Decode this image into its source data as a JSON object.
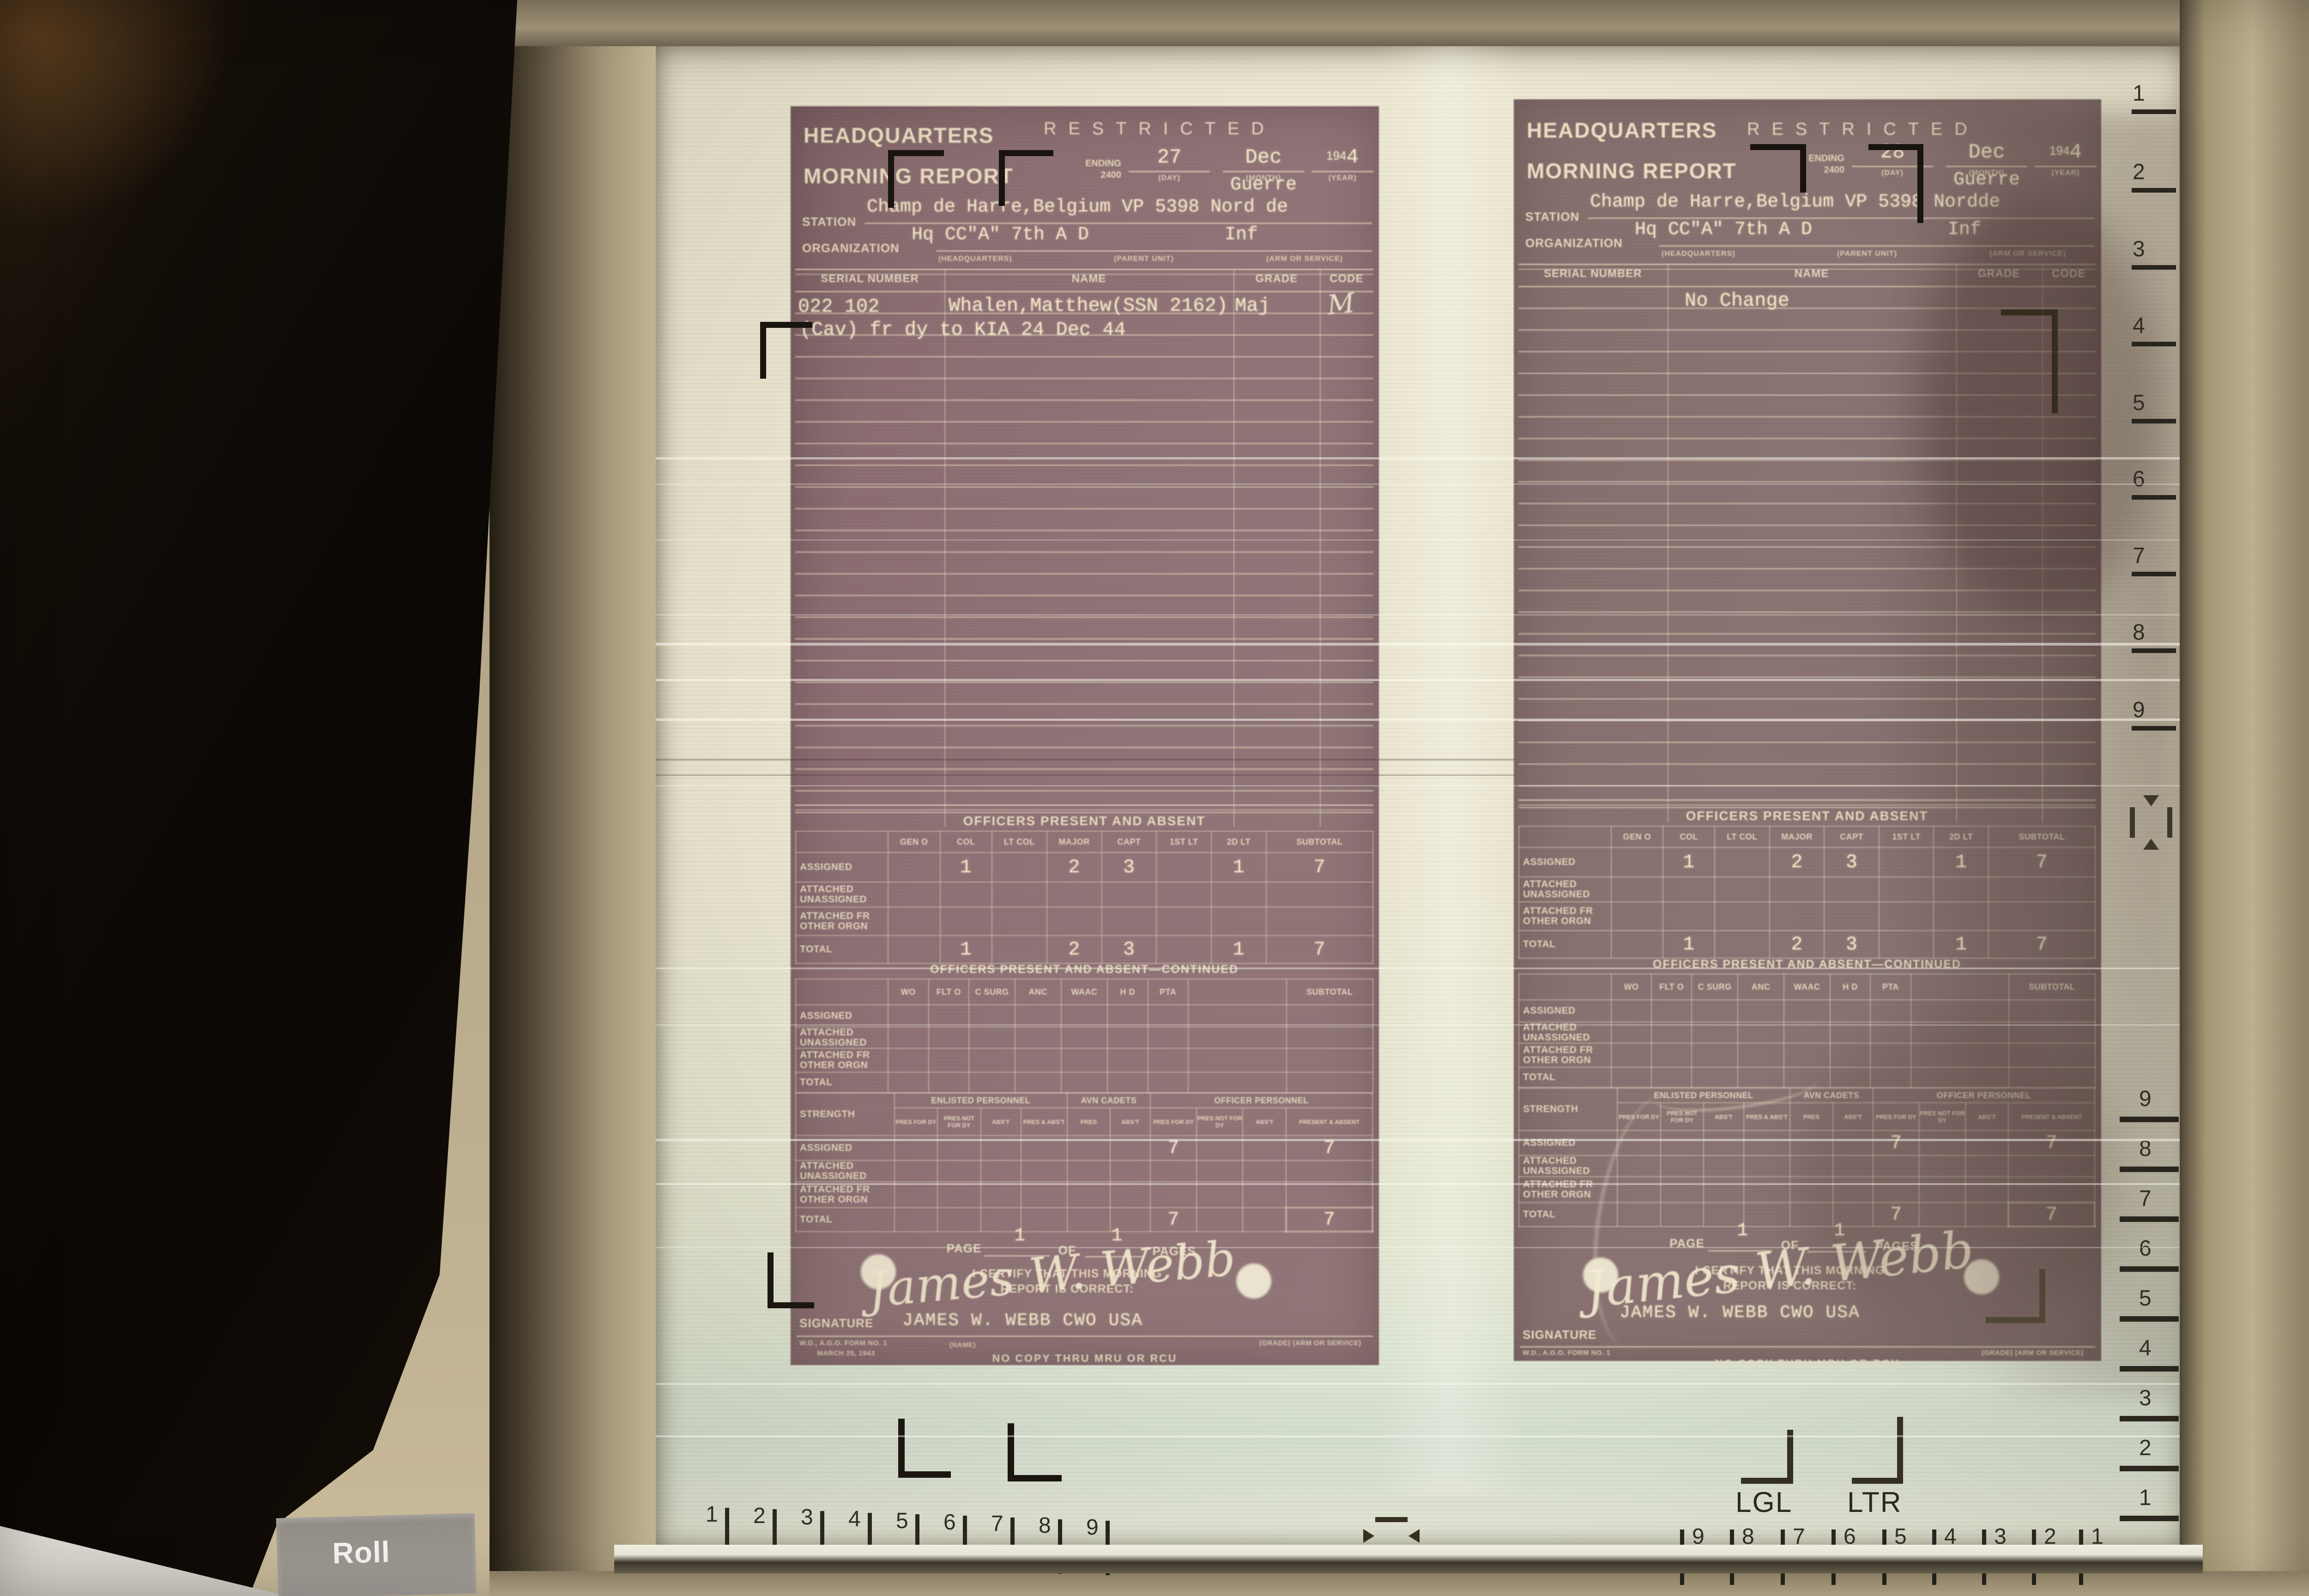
{
  "machine": {
    "roll_button": "Roll",
    "lgl_label": "LGL",
    "ltr_label": "LTR",
    "rulers": {
      "bottom_left": [
        "1",
        "2",
        "3",
        "4",
        "5",
        "6",
        "7",
        "8",
        "9"
      ],
      "bottom_right": [
        "9",
        "8",
        "7",
        "6",
        "5",
        "4",
        "3",
        "2",
        "1"
      ],
      "right_top": [
        "1",
        "2",
        "3",
        "4",
        "5",
        "6",
        "7",
        "8",
        "9"
      ],
      "right_bottom": [
        "9",
        "8",
        "7",
        "6",
        "5",
        "4",
        "3",
        "2",
        "1"
      ]
    },
    "colors": {
      "screen": "#ebe7d1",
      "document": "#8c7073",
      "form_ink": "#e9dcba",
      "frame": "#b3a487",
      "marks": "#17120d"
    }
  },
  "documents": [
    {
      "title_line1": "HEADQUARTERS",
      "title_line2": "MORNING REPORT",
      "classification": "RESTRICTED",
      "ending_label": "ENDING",
      "ending_time": "2400",
      "day": "27",
      "month": "Dec",
      "year_printed": "194",
      "year_typed": "4",
      "year_written": "Guerre",
      "day_label": "(DAY)",
      "month_label": "(MONTH)",
      "year_label": "(YEAR)",
      "station_label": "STATION",
      "station": "Champ de Harre,Belgium VP 5398 Nord de",
      "organization_label": "ORGANIZATION",
      "organization": "Hq CC\"A\" 7th A D",
      "arm_service": "Inf",
      "org_sub_labels": [
        "(HEADQUARTERS)",
        "(PARENT UNIT)",
        "(ARM OR SERVICE)"
      ],
      "roster": {
        "headers": [
          "SERIAL NUMBER",
          "NAME",
          "GRADE",
          "CODE"
        ],
        "entry": {
          "serial": "022 102",
          "name": "Whalen,Matthew(SSN 2162)",
          "grade": "Maj",
          "code": "M"
        },
        "note": "(Cav) fr dy to KIA 24 Dec 44"
      },
      "officers": {
        "title": "OFFICERS PRESENT AND ABSENT",
        "columns": [
          "GEN O",
          "COL",
          "LT COL",
          "MAJOR",
          "CAPT",
          "1ST LT",
          "2D LT",
          "SUBTOTAL"
        ],
        "row_labels": [
          "ASSIGNED",
          "ATTACHED UNASSIGNED",
          "ATTACHED FR OTHER ORGN",
          "TOTAL"
        ],
        "assigned": [
          "",
          "1",
          "",
          "2",
          "3",
          "",
          "1",
          "7"
        ],
        "attached_unassigned": [
          "",
          "",
          "",
          "",
          "",
          "",
          "",
          ""
        ],
        "attached_fr": [
          "",
          "",
          "",
          "",
          "",
          "",
          "",
          ""
        ],
        "total": [
          "",
          "1",
          "",
          "2",
          "3",
          "",
          "1",
          "7"
        ]
      },
      "officers_cont": {
        "title": "OFFICERS PRESENT AND ABSENT—CONTINUED",
        "columns": [
          "WO",
          "FLT O",
          "C SURG",
          "ANC",
          "WAAC",
          "H D",
          "PTA",
          "",
          "SUBTOTAL"
        ]
      },
      "strength": {
        "title": "STRENGTH",
        "groups": [
          "ENLISTED PERSONNEL",
          "AVN CADETS",
          "OFFICER PERSONNEL"
        ],
        "enlisted_cols": [
          "PRES FOR DY",
          "PRES NOT FOR DY",
          "ABS'T",
          "PRES & ABS'T"
        ],
        "avn_cols": [
          "PRES",
          "ABS'T"
        ],
        "officer_cols": [
          "PRES FOR DY",
          "PRES NOT FOR DY",
          "ABS'T",
          "PRESENT & ABSENT"
        ],
        "assigned": {
          "officer_pres_dy": "7",
          "present_absent": "7"
        },
        "total": {
          "officer_pres_dy": "7",
          "present_absent": "7"
        }
      },
      "page": {
        "page_label": "PAGE",
        "page_number": "1",
        "of_label": "OF",
        "pages_number": "1",
        "pages_label": "PAGES"
      },
      "certification": {
        "text_line1": "I CERTIFY THAT THIS MORNING",
        "text_line2": "REPORT IS CORRECT:",
        "signature_script": "James W. Webb",
        "signature_label": "SIGNATURE",
        "signature_typed": "JAMES W. WEBB CWO USA",
        "form_id": "W.D., A.G.O. FORM NO. 1",
        "form_date": "MARCH 25, 1943",
        "name_sub_label": "(NAME)",
        "grade_sub_label": "(GRADE) (ARM OR SERVICE)",
        "footer": "NO COPY THRU MRU OR RCU"
      }
    },
    {
      "title_line1": "HEADQUARTERS",
      "title_line2": "MORNING REPORT",
      "classification": "RESTRICTED",
      "ending_label": "ENDING",
      "ending_time": "2400",
      "day": "28",
      "month": "Dec",
      "year_printed": "194",
      "year_typed": "4",
      "year_written": "Guerre",
      "day_label": "(DAY)",
      "month_label": "(MONTH)",
      "year_label": "(YEAR)",
      "station_label": "STATION",
      "station": "Champ de Harre,Belgium VP 5398 Nordde",
      "organization_label": "ORGANIZATION",
      "organization": "Hq CC\"A\" 7th A D",
      "arm_service": "Inf",
      "org_sub_labels": [
        "(HEADQUARTERS)",
        "(PARENT UNIT)",
        "(ARM OR SERVICE)"
      ],
      "roster": {
        "headers": [
          "SERIAL NUMBER",
          "NAME",
          "GRADE",
          "CODE"
        ],
        "entry": {
          "serial": "",
          "name": "No Change",
          "grade": "",
          "code": ""
        },
        "note": ""
      },
      "officers": {
        "title": "OFFICERS PRESENT AND ABSENT",
        "columns": [
          "GEN O",
          "COL",
          "LT COL",
          "MAJOR",
          "CAPT",
          "1ST LT",
          "2D LT",
          "SUBTOTAL"
        ],
        "row_labels": [
          "ASSIGNED",
          "ATTACHED UNASSIGNED",
          "ATTACHED FR OTHER ORGN",
          "TOTAL"
        ],
        "assigned": [
          "",
          "1",
          "",
          "2",
          "3",
          "",
          "1",
          "7"
        ],
        "attached_unassigned": [
          "",
          "",
          "",
          "",
          "",
          "",
          "",
          ""
        ],
        "attached_fr": [
          "",
          "",
          "",
          "",
          "",
          "",
          "",
          ""
        ],
        "total": [
          "",
          "1",
          "",
          "2",
          "3",
          "",
          "1",
          "7"
        ]
      },
      "officers_cont": {
        "title": "OFFICERS PRESENT AND ABSENT—CONTINUED",
        "columns": [
          "WO",
          "FLT O",
          "C SURG",
          "ANC",
          "WAAC",
          "H D",
          "PTA",
          "",
          "SUBTOTAL"
        ]
      },
      "strength": {
        "title": "STRENGTH",
        "groups": [
          "ENLISTED PERSONNEL",
          "AVN CADETS",
          "OFFICER PERSONNEL"
        ],
        "enlisted_cols": [
          "PRES FOR DY",
          "PRES NOT FOR DY",
          "ABS'T",
          "PRES & ABS'T"
        ],
        "avn_cols": [
          "PRES",
          "ABS'T"
        ],
        "officer_cols": [
          "PRES FOR DY",
          "PRES NOT FOR DY",
          "ABS'T",
          "PRESENT & ABSENT"
        ],
        "assigned": {
          "officer_pres_dy": "7",
          "present_absent": "7"
        },
        "total": {
          "officer_pres_dy": "7",
          "present_absent": "7"
        }
      },
      "page": {
        "page_label": "PAGE",
        "page_number": "1",
        "of_label": "OF",
        "pages_number": "1",
        "pages_label": "PAGES"
      },
      "certification": {
        "text_line1": "I CERTIFY THAT THIS MORNING",
        "text_line2": "REPORT IS CORRECT:",
        "signature_script": "James W. Webb",
        "signature_label": "SIGNATURE",
        "signature_typed": "JAMES W. WEBB CWO USA",
        "form_id": "W.D., A.G.O. FORM NO. 1",
        "form_date": "MARCH 25, 1943",
        "name_sub_label": "(NAME)",
        "grade_sub_label": "(GRADE) (ARM OR SERVICE)",
        "footer": "NO COPY THRU MRU OR RCU"
      }
    }
  ]
}
